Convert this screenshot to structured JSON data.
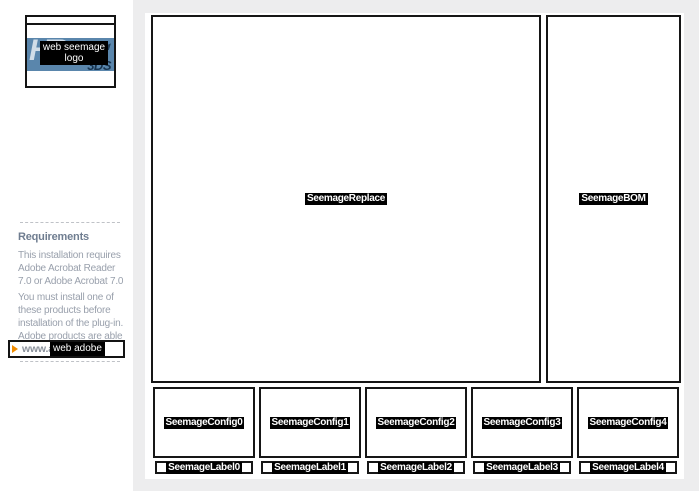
{
  "logo": {
    "alt_line1": "web seemage",
    "alt_line2": "logo",
    "brand": "HR",
    "brand_sub": "3DS"
  },
  "sidebar": {
    "heading": "Requirements",
    "para1": [
      "This installation requires",
      "Adobe Acrobat Reader",
      "7.0 or Adobe Acrobat 7.0"
    ],
    "para2": [
      "You must install one of",
      "these products before",
      "installation of the plug-in.",
      "Adobe products are able",
      "on Adobe web site:"
    ],
    "link_text": "www.adobe.com",
    "link_overlay": "web adobe"
  },
  "main": {
    "replace_label": "SeemageReplace",
    "bom_label": "SeemageBOM",
    "config_labels": [
      "SeemageConfig0",
      "SeemageConfig1",
      "SeemageConfig2",
      "SeemageConfig3",
      "SeemageConfig4"
    ],
    "label_labels": [
      "SeemageLabel0",
      "SeemageLabel1",
      "SeemageLabel2",
      "SeemageLabel3",
      "SeemageLabel4"
    ]
  },
  "colors": {
    "panel_bg": "#ededee",
    "border_black": "#161616",
    "band_blue": "#5a86ac",
    "brand_navy": "#18344f",
    "arrow_orange": "#f08c00",
    "sidebar_text": "#99a0ac",
    "sidebar_heading": "#6f7d90"
  }
}
